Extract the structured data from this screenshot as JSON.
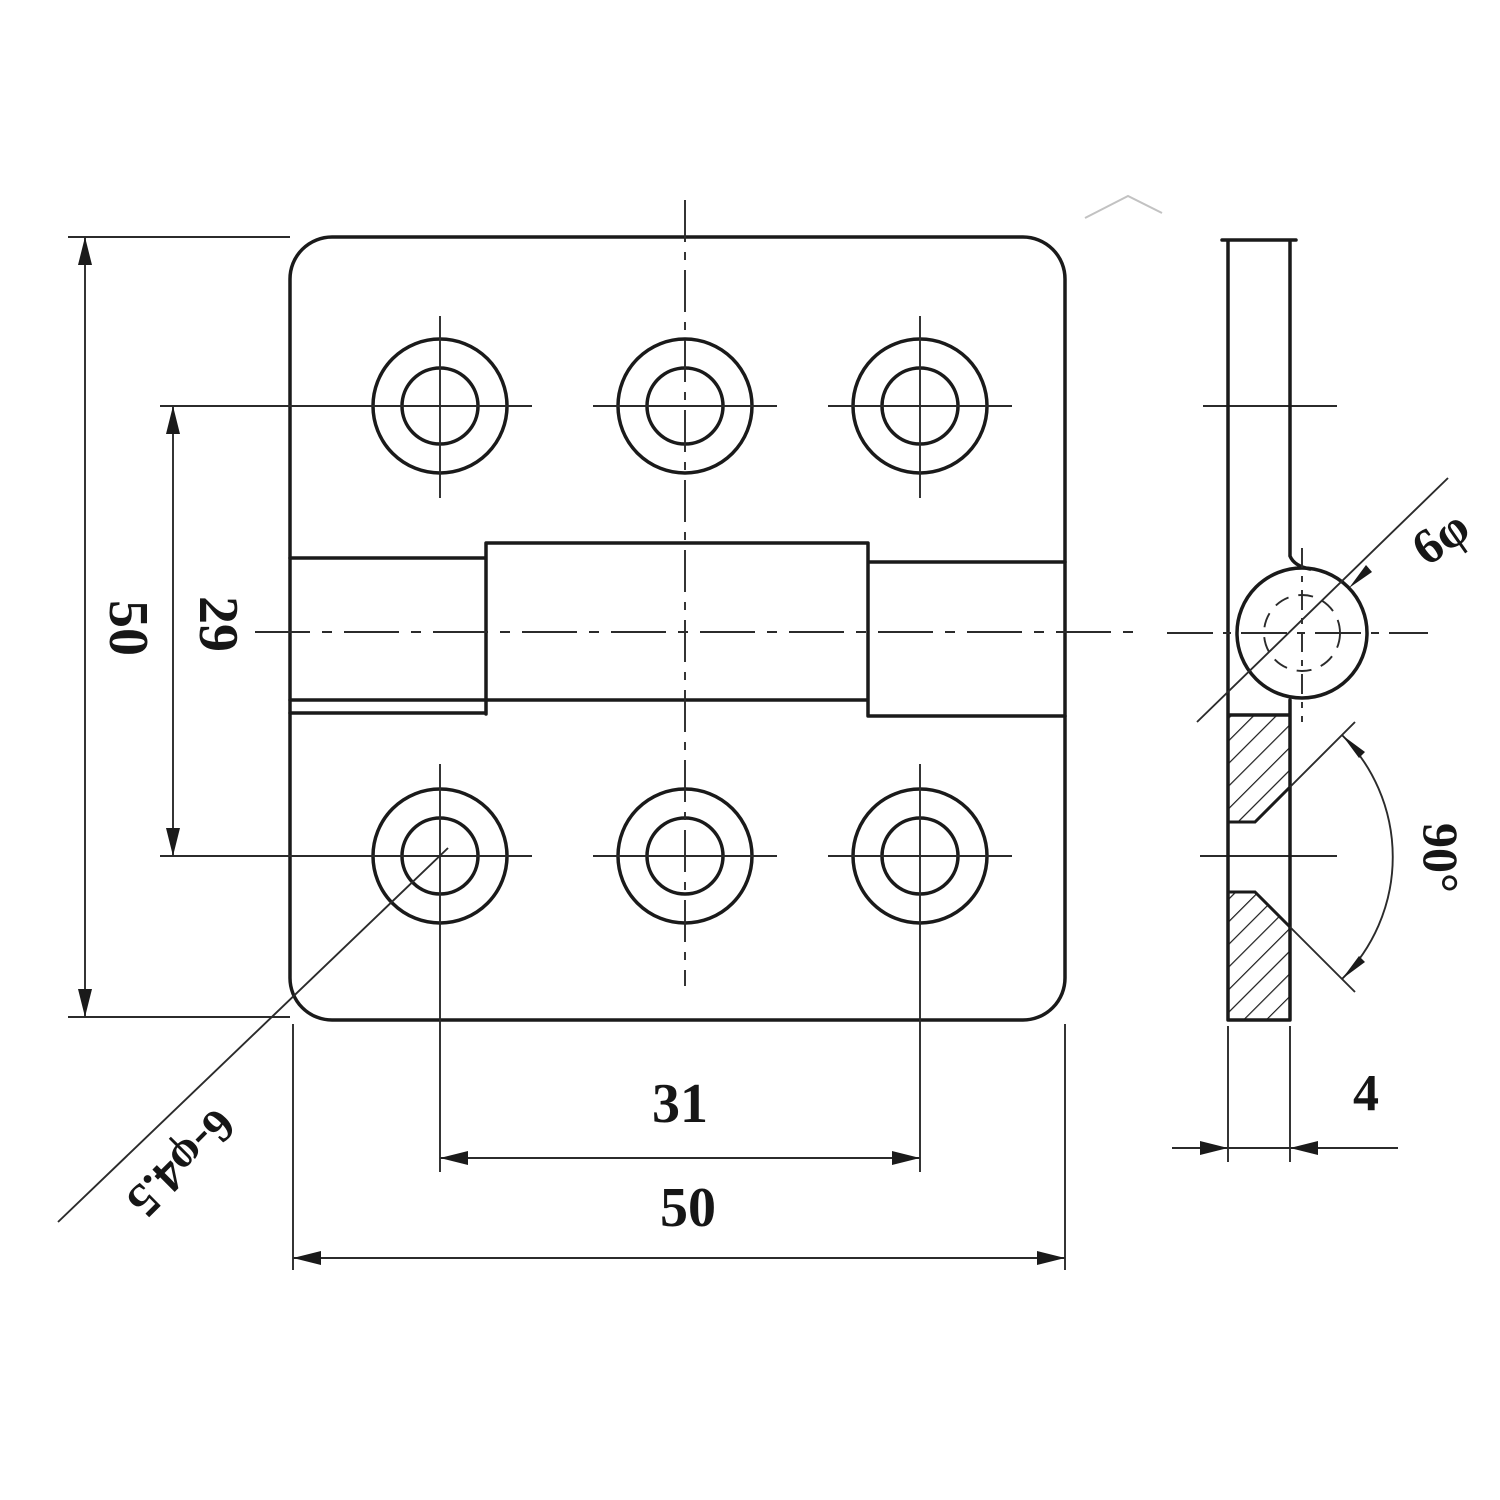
{
  "drawing": {
    "title": "hinge technical drawing - front view and side section view",
    "front_view": {
      "dim_height": "50",
      "dim_hole_row_spacing": "29",
      "dim_hole_col_spacing": "31",
      "dim_width": "50",
      "hole_callout": "6-φ4.5"
    },
    "side_view": {
      "dim_thickness": "4",
      "dim_barrel_diameter": "6φ",
      "dim_countersink_angle": "90°"
    },
    "colors": {
      "line": "#1a1a1a",
      "background": "#ffffff"
    }
  }
}
